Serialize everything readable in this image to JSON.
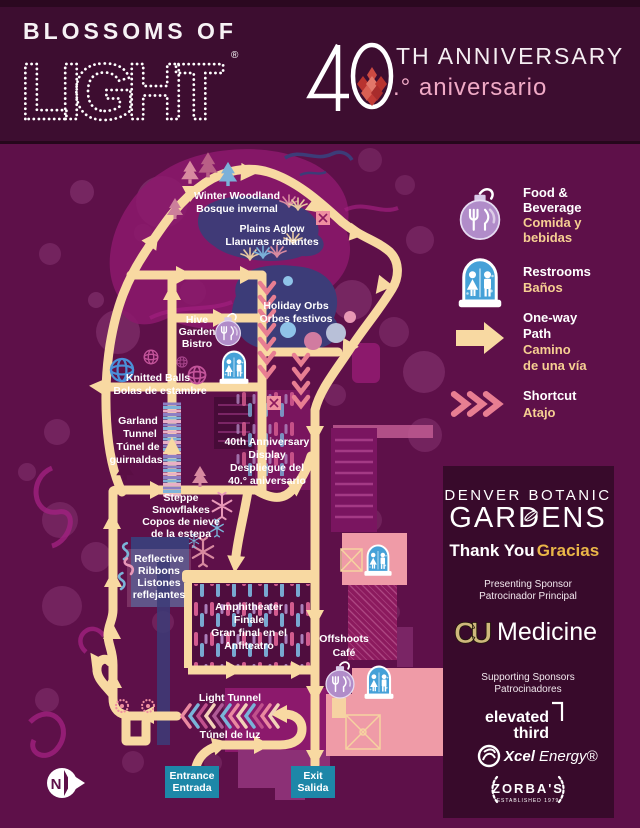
{
  "header": {
    "brand_line1": "BLOSSOMS OF",
    "brand_line2": "LIGHT",
    "registered_mark": "®",
    "anniversary_suffix": "TH ANNIVERSARY",
    "anniversary_es": ".° aniversario"
  },
  "legend": {
    "items": [
      {
        "icon": "food-ornament-icon",
        "en1": "Food &",
        "en2": "Beverage",
        "es1": "Comida y",
        "es2": "bebidas"
      },
      {
        "icon": "restroom-snowglobe-icon",
        "en1": "Restrooms",
        "es1": "Baños"
      },
      {
        "icon": "one-way-arrow-icon",
        "en1": "One-way",
        "en2": "Path",
        "es1": "Camino",
        "es2": "de una vía"
      },
      {
        "icon": "shortcut-chevrons-icon",
        "en1": "Shortcut",
        "es1": "Atajo"
      }
    ]
  },
  "map": {
    "labels": [
      {
        "lines": [
          "Winter Woodland",
          "Bosque invernal"
        ]
      },
      {
        "lines": [
          "Plains Aglow",
          "Llanuras radiantes"
        ]
      },
      {
        "lines": [
          "Holiday Orbs",
          "Orbes festivos"
        ]
      },
      {
        "lines": [
          "Hive",
          "Garden",
          "Bistro"
        ]
      },
      {
        "lines": [
          "Knitted Balls",
          "Bolas de estambre"
        ]
      },
      {
        "lines": [
          "Garland",
          "Tunnel",
          "Túnel de",
          "guirnaldas"
        ]
      },
      {
        "lines": [
          "40th Anniversary",
          "Display",
          "Despliegue del",
          "40.° aniversario"
        ]
      },
      {
        "lines": [
          "Steppe",
          "Snowflakes",
          "Copos de nieve",
          "de la estepa"
        ]
      },
      {
        "lines": [
          "Reflective",
          "Ribbons",
          "Listones",
          "reflejantes"
        ]
      },
      {
        "lines": [
          "Amphitheater",
          "Finale",
          "Gran final en el",
          "Anfiteatro"
        ]
      },
      {
        "lines": [
          "Offshoots",
          "Café"
        ]
      },
      {
        "lines": [
          "Light Tunnel"
        ]
      },
      {
        "lines": [
          "Túnel de luz"
        ]
      }
    ],
    "entrance": {
      "en": "Entrance",
      "es": "Entrada"
    },
    "exit": {
      "en": "Exit",
      "es": "Salida"
    },
    "compass": "N"
  },
  "sponsors": {
    "gardens_line1": "DENVER BOTANIC",
    "gardens_line2": "GARDENS",
    "thank_you_en": "Thank You",
    "thank_you_es": "Gracias",
    "presenting_label_en": "Presenting Sponsor",
    "presenting_label_es": "Patrocinador Principal",
    "presenting_mark": "CU",
    "presenting_name": "Medicine",
    "supporting_label_en": "Supporting Sponsors",
    "supporting_label_es": "Patrocinadores",
    "elevated_line1": "elevated",
    "elevated_line2": "third",
    "xcel_word1": "Xcel",
    "xcel_word2": "Energy®",
    "zorbas_name": "ZORBA'S",
    "zorbas_tagline": "ESTABLISHED 1979"
  },
  "colors": {
    "background": "#5e1049",
    "header_background": "#3d0d30",
    "path_tan": "#f8d9a2",
    "magenta_region": "#8c196c",
    "blue_region": "#3c3c78",
    "pink_building": "#ef9ba7",
    "shortcut_pink": "#e87e92",
    "entrance_teal": "#1d87a8",
    "panel_plum": "#380a2b",
    "cu_gold": "#cfb87c",
    "gracias_gold": "#eab648",
    "anniversary_pink": "#f0aac6"
  }
}
